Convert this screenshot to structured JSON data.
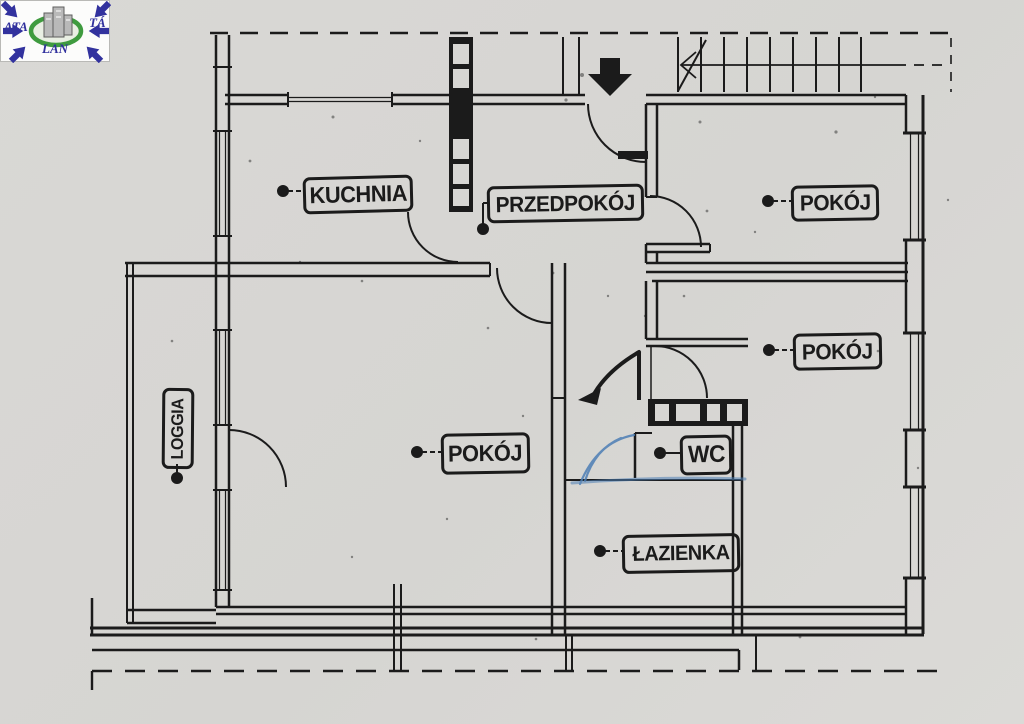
{
  "document": {
    "type": "scanned apartment floor plan",
    "language": "Polish"
  },
  "logo": {
    "left": "ATA",
    "right": "TÁ",
    "bottom": "LAN"
  },
  "floor_plan": {
    "rooms": [
      {
        "id": "kuchnia",
        "label": "KUCHNIA"
      },
      {
        "id": "przedpokoj",
        "label": "PRZEDPOKÓJ"
      },
      {
        "id": "pokoj-top-right",
        "label": "POKÓJ"
      },
      {
        "id": "pokoj-mid-right",
        "label": "POKÓJ"
      },
      {
        "id": "pokoj-center",
        "label": "POKÓJ"
      },
      {
        "id": "wc",
        "label": "WC"
      },
      {
        "id": "lazienka",
        "label": "ŁAZIENKA"
      },
      {
        "id": "loggia",
        "label": "LOGGIA"
      }
    ],
    "features": [
      "staircase with direction line at top right",
      "entrance arrow pointing down into hallway",
      "door swing arcs",
      "ventilation shaft hatching between kitchen and hallway and beside WC",
      "hand-drawn blue pen correction at WC door",
      "dashed building outline at top and bottom"
    ]
  },
  "colors": {
    "ink": "#1b1b1b",
    "paper": "#d7d6d3",
    "annotation_blue": "#4d7fb5",
    "logo_blue": "#32329e",
    "logo_green": "#3f9b3f"
  }
}
